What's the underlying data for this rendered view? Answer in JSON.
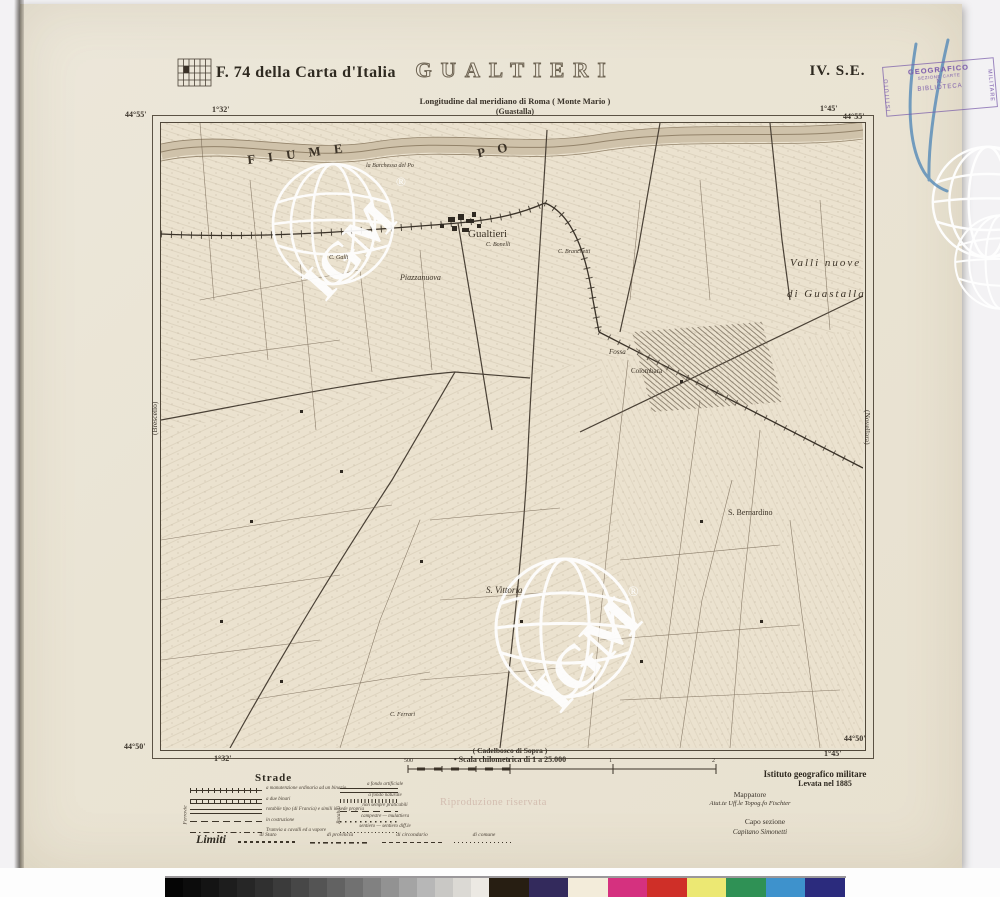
{
  "header": {
    "sheet_ref": "F. 74 della Carta d'Italia",
    "title": "GUALTIERI",
    "quadrant": "IV. S.E.",
    "longitude_note": "Longitudine dal meridiano di Roma ( Monte Mario )",
    "reference_sheet": "(Guastalla)"
  },
  "stamp": {
    "left_vertical": "ISTITUTO",
    "top": "GEOGRAFICO",
    "line2": "SEZIONE CARTE",
    "line3": "N.",
    "line4": "BIBLIOTECA",
    "right_vertical": "MILITARE",
    "ink_color": "#7a5aab"
  },
  "corners": {
    "top_left_lat": "44°55'",
    "top_left_lon": "1°32'",
    "top_right_lon": "1°45'",
    "top_right_lat": "44°55'",
    "bottom_left_lat": "44°50'",
    "bottom_left_lon": "1°32'",
    "bottom_right_lat": "44°50'",
    "bottom_right_lon": "1°45'"
  },
  "map": {
    "edge_left": "(Brescello)",
    "edge_right": "(Novellara)",
    "bottom_adjacent": "( Cadelbosco di Sopra )",
    "labels": [
      {
        "text": "F I U M E",
        "x": 247,
        "y": 146,
        "fs": 13,
        "rot": -7,
        "ls": 5,
        "b": 1
      },
      {
        "text": "P O",
        "x": 477,
        "y": 142,
        "fs": 13,
        "rot": -12,
        "ls": 5,
        "b": 1
      },
      {
        "text": "Gualtieri",
        "x": 468,
        "y": 228,
        "fs": 11
      },
      {
        "text": "Piazzanuova",
        "x": 400,
        "y": 273,
        "fs": 8,
        "it": 1
      },
      {
        "text": "Valli   nuove",
        "x": 790,
        "y": 257,
        "fs": 11,
        "it": 1,
        "ls": 2
      },
      {
        "text": "di  Guastalla",
        "x": 787,
        "y": 288,
        "fs": 11,
        "it": 1,
        "ls": 2
      },
      {
        "text": "Fossa",
        "x": 609,
        "y": 348,
        "fs": 7,
        "it": 1
      },
      {
        "text": "Colombara",
        "x": 631,
        "y": 367,
        "fs": 7
      },
      {
        "text": "S. Bernardino",
        "x": 728,
        "y": 508,
        "fs": 8
      },
      {
        "text": "S. Vittoria",
        "x": 486,
        "y": 585,
        "fs": 9,
        "it": 1
      },
      {
        "text": "la Barchessa del Po",
        "x": 366,
        "y": 163,
        "fs": 6,
        "it": 1
      },
      {
        "text": "C. Bonelli",
        "x": 486,
        "y": 242,
        "fs": 6,
        "it": 1
      },
      {
        "text": "C. Branchetti",
        "x": 558,
        "y": 249,
        "fs": 6,
        "it": 1
      },
      {
        "text": "C. Galli",
        "x": 329,
        "y": 255,
        "fs": 6,
        "it": 1
      },
      {
        "text": "C. Ferrari",
        "x": 390,
        "y": 712,
        "fs": 6,
        "it": 1
      }
    ]
  },
  "scale": {
    "caption": "Scala chilometrica di 1 a 25.000",
    "tick_labels": [
      "500",
      "0",
      "1",
      "2"
    ]
  },
  "legend": {
    "strade_title": "Strade",
    "bracket_left": "Ferrovie",
    "bracket_right": "Rotabili",
    "strade_left": [
      {
        "style": "ls-rail1",
        "label": "a manutenzione ordinaria ad un binario"
      },
      {
        "style": "ls-rail2",
        "label": "a due binari"
      },
      {
        "style": "ls-double",
        "label": "rotabile tipo (di Francia) e simili in sede propria"
      },
      {
        "style": "ls-dash",
        "label": "in costruzione"
      },
      {
        "style": "ls-dashdot",
        "label": "Tramvia a cavalli ed a vapore"
      }
    ],
    "strade_right": [
      {
        "style": "ls-double",
        "label": "a fondo artificiale"
      },
      {
        "style": "ls-hatch",
        "label": "a fondo naturale"
      },
      {
        "style": "ls-dash",
        "label": "non sempre praticabili"
      },
      {
        "style": "ls-dot",
        "label": "campestre — mulattiera"
      },
      {
        "style": "ls-dotfine",
        "label": "sentiero — sentiero diff.le"
      }
    ],
    "limiti_title": "Limiti",
    "limiti": [
      {
        "style": "lm-a",
        "label": "di Stato"
      },
      {
        "style": "lm-b",
        "label": "di provincia"
      },
      {
        "style": "lm-c",
        "label": "di circondario"
      },
      {
        "style": "lm-d",
        "label": "di comune"
      }
    ]
  },
  "credits": {
    "institute": "Istituto geografico militare",
    "survey": "Levata nel 1885",
    "mapper_title": "Mappatore",
    "mapper_name": "Aiut.te Uff.le Topog.fo  Fischter",
    "chief_title": "Capo sezione",
    "chief_name": "Capitano   Simonetti"
  },
  "watermarks": {
    "igm_text": "IGM",
    "registered": "®",
    "notice": "Riproduzione riservata"
  },
  "colorbar": {
    "gray_steps": [
      "#050505",
      "#0c0c0c",
      "#141414",
      "#1d1d1d",
      "#262626",
      "#303030",
      "#3b3b3b",
      "#474747",
      "#545454",
      "#626262",
      "#717171",
      "#818181",
      "#929292",
      "#a4a4a4",
      "#b7b7b7",
      "#c9c8c5",
      "#dbd9d4",
      "#ece9e3"
    ],
    "color_patches": [
      "#271e12",
      "#332a5c",
      "#f3ecda",
      "#d5317f",
      "#cf2f28",
      "#ece873",
      "#2f9155",
      "#3e92cc",
      "#2b2b7d"
    ]
  }
}
